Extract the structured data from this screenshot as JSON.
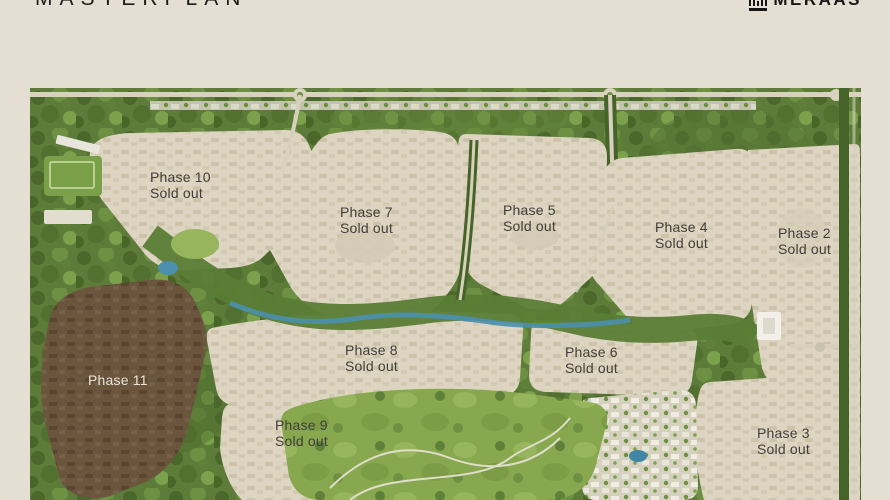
{
  "header": {
    "title": "MASTERPLAN",
    "brand": "MERAAS"
  },
  "map": {
    "phases": [
      {
        "id": "phase-10",
        "name": "Phase 10",
        "status": "Sold out"
      },
      {
        "id": "phase-7",
        "name": "Phase 7",
        "status": "Sold out"
      },
      {
        "id": "phase-5",
        "name": "Phase 5",
        "status": "Sold out"
      },
      {
        "id": "phase-4",
        "name": "Phase 4",
        "status": "Sold out"
      },
      {
        "id": "phase-2",
        "name": "Phase 2",
        "status": "Sold out"
      },
      {
        "id": "phase-8",
        "name": "Phase 8",
        "status": "Sold out"
      },
      {
        "id": "phase-6",
        "name": "Phase 6",
        "status": "Sold out"
      },
      {
        "id": "phase-11",
        "name": "Phase 11",
        "status": ""
      },
      {
        "id": "phase-9",
        "name": "Phase 9",
        "status": "Sold out"
      },
      {
        "id": "phase-3",
        "name": "Phase 3",
        "status": "Sold out"
      }
    ],
    "colors": {
      "page_background": "#e4dfd2",
      "title_text": "#1b1b19",
      "parcel_beige": "#ddd5c1",
      "parcel_brown": "#6b553d",
      "trees_green": "#5d7c39",
      "park_green": "#88a850",
      "water_teal": "#4a8fae",
      "road_light": "#d8d2bf",
      "label_dark": "#3f3e39",
      "label_light": "#ece7db"
    }
  }
}
